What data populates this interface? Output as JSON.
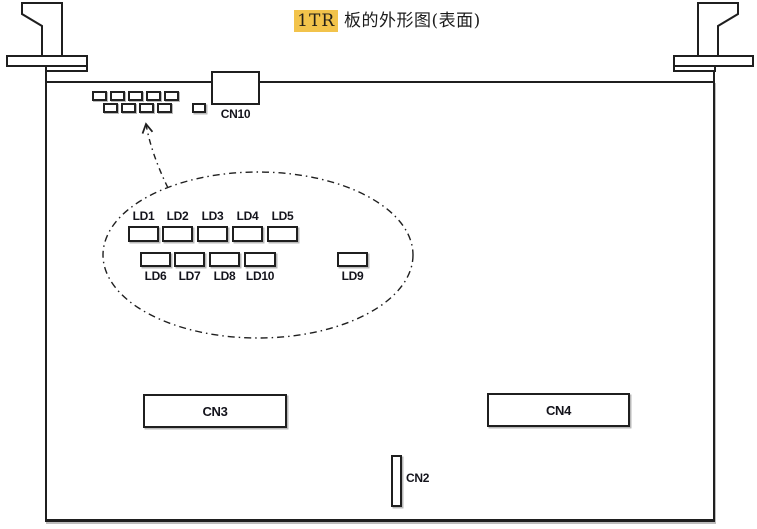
{
  "title": {
    "highlighted": "1TR",
    "text": "板的外形图(表面)",
    "highlight_color": "#F2C34B"
  },
  "connectors": {
    "cn10": {
      "label": "CN10"
    },
    "cn3": {
      "label": "CN3"
    },
    "cn4": {
      "label": "CN4"
    },
    "cn2": {
      "label": "CN2"
    }
  },
  "leds": {
    "top_row": [
      {
        "label": "LD1"
      },
      {
        "label": "LD2"
      },
      {
        "label": "LD3"
      },
      {
        "label": "LD4"
      },
      {
        "label": "LD5"
      }
    ],
    "bottom_row": [
      {
        "label": "LD6"
      },
      {
        "label": "LD7"
      },
      {
        "label": "LD8"
      },
      {
        "label": "LD10"
      },
      {
        "label": "LD9"
      }
    ]
  },
  "colors": {
    "line": "#1f1f1f",
    "highlight_bg": "#F2C34B",
    "board_fill": "#ffffff"
  }
}
